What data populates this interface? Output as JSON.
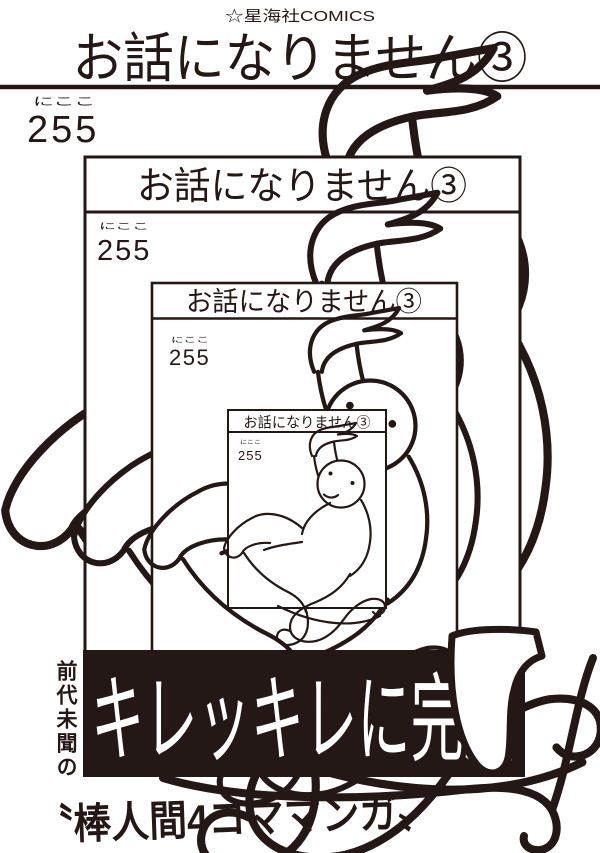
{
  "publisher_mark": "☆星海社COMICS",
  "cover": {
    "title": "お話になりません③",
    "author": "255",
    "author_furigana": "にここ"
  },
  "banner": {
    "text": "キレッキレに完結",
    "background": "#231815",
    "text_color": "#ffffff"
  },
  "taglines": {
    "vertical": "前代未聞の",
    "bottom": "〝棒人間4コママンガ〟"
  },
  "colors": {
    "ink": "#231815",
    "paper": "#ffffff"
  }
}
